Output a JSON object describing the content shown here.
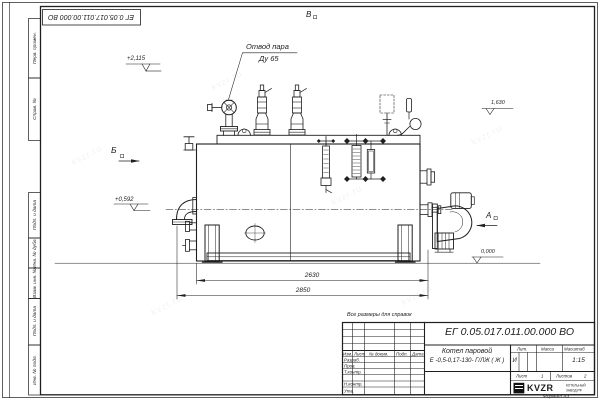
{
  "watermark_text": "kvzr.ru",
  "frame": {
    "doc_number_top": "ЕГ 0.05.017.011.00.000  ВО",
    "margin_labels": [
      "Перв. примен.",
      "Справ. №",
      "Подп. и дата",
      "Инв. № дубл.",
      "Взам. инв. №",
      "Подп. и дата",
      "Инв. № подл."
    ],
    "format_note": "Формат А3"
  },
  "annotations": {
    "steam_outlet_title": "Отвод пара",
    "steam_outlet_size": "Ду 65",
    "note_reference": "Все размеры для справок",
    "elevation_top": "+2,115",
    "elevation_mid": "+0,592",
    "elevation_right": "1,630",
    "elevation_zero": "0,000",
    "view_left": "Б",
    "view_top": "В",
    "view_right": "А",
    "dim_inner": "2630",
    "dim_overall": "2850"
  },
  "stamp": {
    "doc_number": "ЕГ 0.05.017.011.00.000  ВО",
    "product_name": "Котел паровой",
    "product_type": "Е -0,5-0,17-130- Г/ЛЖ ( Ж )",
    "columns": [
      "Изм.",
      "Лист",
      "№ докум.",
      "Подп.",
      "Дата"
    ],
    "sig_rows": [
      "Разраб.",
      "Пров.",
      "Т.контр.",
      "Н.контр.",
      "Утв."
    ],
    "litera_header": "Лит.",
    "mass_header": "Масса",
    "scale_header": "Масштаб",
    "litera": "И",
    "scale": "1:15",
    "sheet_label": "Лист",
    "sheet_number": "1",
    "sheets_label": "Листов",
    "sheets_total": "2",
    "logo": "KVZR",
    "logo_caption_line1": "КОТЕЛЬНЫЙ",
    "logo_caption_line2": "ЗАВОД.РФ"
  }
}
